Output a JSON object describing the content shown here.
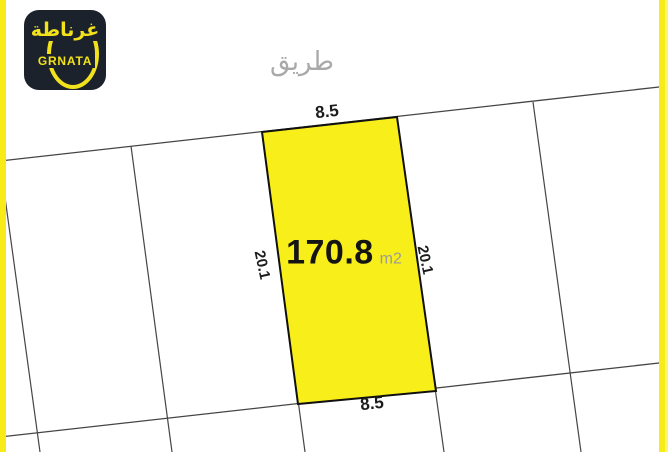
{
  "logo": {
    "arabic_name": "غرناطة",
    "latin_name": "GRNATA",
    "bg_color": "#1c222c",
    "accent_color": "#f2e21b"
  },
  "road_label": "طريق",
  "plot": {
    "area_value": "170.8",
    "area_unit": "m2",
    "width_top": "8.5",
    "width_bottom": "8.5",
    "length_left": "20.1",
    "length_right": "20.1",
    "highlight_color": "#f8ee1a"
  },
  "colors": {
    "edge_stripe_yellow": "#f8ec18",
    "parcel_line_gray": "#454545",
    "plot_border_black": "#101010",
    "road_text_gray": "#a9a9a9",
    "area_unit_gray": "#9b9b9b"
  }
}
